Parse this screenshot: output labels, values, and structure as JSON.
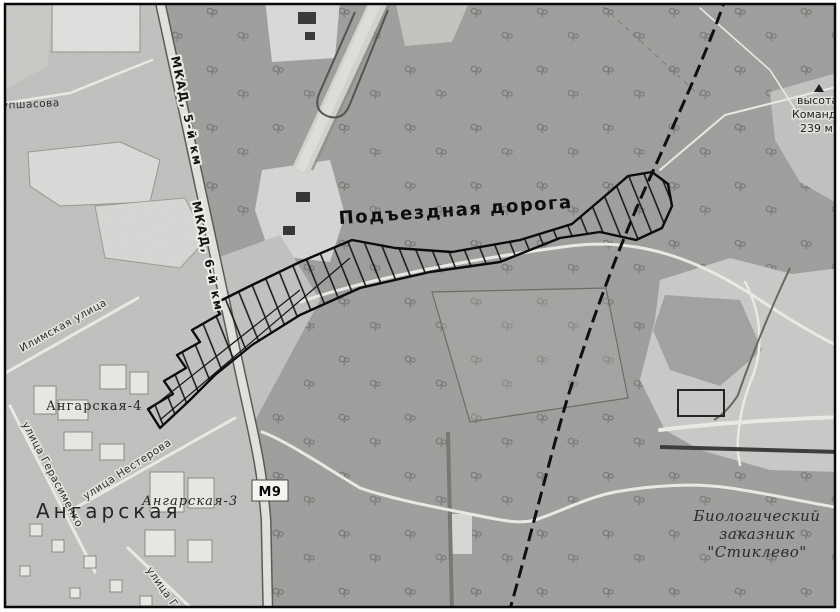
{
  "map": {
    "corridor_label": "Подъездная дорога",
    "roads": {
      "mkad_km5": "МКАД, 5-й км",
      "mkad_km6": "МКАД, 6-й км",
      "badge_m9": "М9"
    },
    "streets": {
      "vaupshasova": "упшасова",
      "ilimskaya": "Илимская улица",
      "gerasimenko": "улица Герасименко",
      "nesterova": "улица Нестерова",
      "ge": "улица Ге"
    },
    "districts": {
      "angarskaya": "Ангарская",
      "angarskaya3": "Ангарская-3",
      "angarskaya4": "Ангарская-4"
    },
    "poi": {
      "height": [
        "высота",
        "Командн",
        "239 м"
      ],
      "reserve": [
        "Биологический",
        "заказник",
        "\"Стиклево\""
      ]
    },
    "palette": {
      "forest": "#a4a3a1",
      "urban": "#c6c5c3",
      "field": "#e3e2e0",
      "ink": "#111111"
    }
  }
}
